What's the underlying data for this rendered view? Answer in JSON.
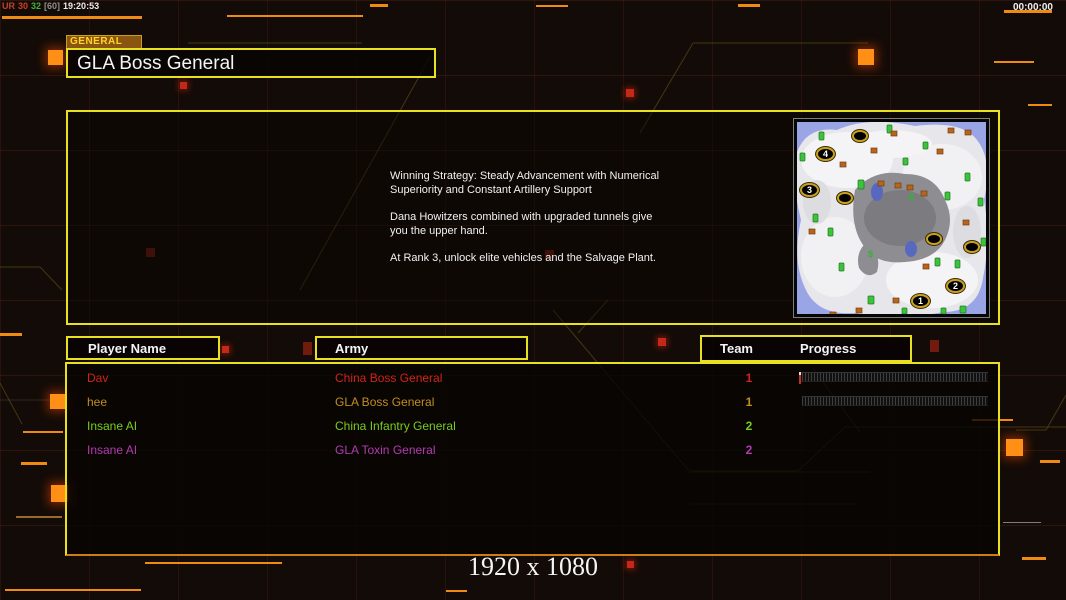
{
  "colors": {
    "accent_yellow": "#e9e11f",
    "accent_orange": "#ef8b13",
    "tab_bg": "#8a5510",
    "tab_text": "#ffd427"
  },
  "status_bar": {
    "fps_label": "UR",
    "fps_value": "30",
    "fps_value2": "32",
    "fps_cap": "[60]",
    "clock": "19:20:53",
    "match_timer": "00:00:00"
  },
  "header": {
    "tab_label": "GENERAL",
    "title": "GLA Boss General"
  },
  "briefing": {
    "paragraph1": "Winning Strategy: Steady Advancement with Numerical\n Superiority and Constant Artillery Support",
    "paragraph2": "Dana Howitzers combined with upgraded tunnels give\n you the upper hand.",
    "paragraph3": "At Rank 3, unlock elite vehicles and the Salvage Plant."
  },
  "map_preview": {
    "start_positions": [
      {
        "label": "4"
      },
      {
        "label": "3"
      },
      {
        "label": "2"
      },
      {
        "label": "1"
      }
    ]
  },
  "lobby_table": {
    "headers": {
      "player_name": "Player Name",
      "army": "Army",
      "team": "Team",
      "progress": "Progress"
    },
    "rows": [
      {
        "name": "Dav",
        "army": "China Boss General",
        "team": "1",
        "color": "#d02418",
        "has_progress_bar": true
      },
      {
        "name": "hee",
        "army": "GLA Boss General",
        "team": "1",
        "color": "#c28e1e",
        "has_progress_bar": true
      },
      {
        "name": "Insane AI",
        "army": "China Infantry General",
        "team": "2",
        "color": "#78cc1e",
        "has_progress_bar": false
      },
      {
        "name": "Insane AI",
        "army": "GLA Toxin General",
        "team": "2",
        "color": "#b03cb0",
        "has_progress_bar": false
      }
    ]
  },
  "footer": {
    "resolution_label": "1920 x 1080"
  }
}
